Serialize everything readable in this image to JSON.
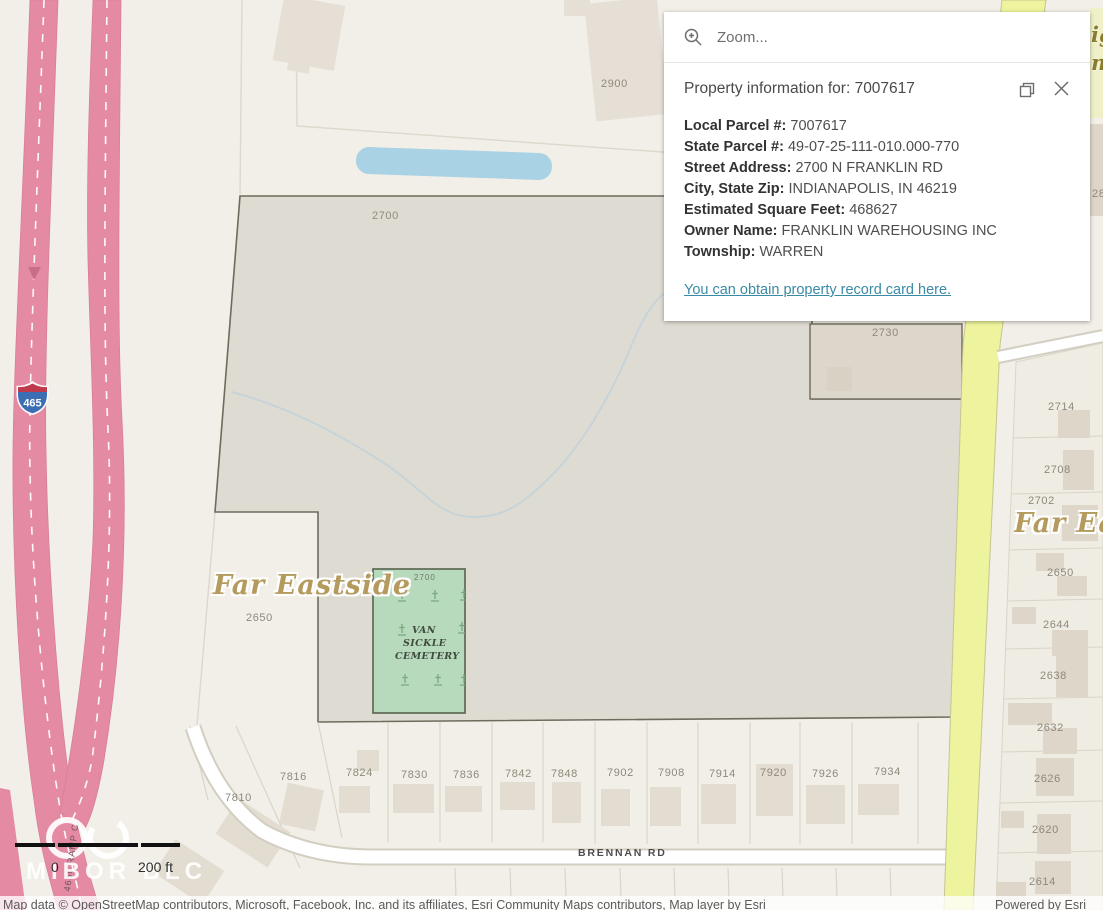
{
  "search": {
    "placeholder": "Zoom..."
  },
  "popup": {
    "title": "Property information for: 7007617",
    "fields": [
      {
        "label": "Local Parcel #:",
        "value": "7007617"
      },
      {
        "label": "State Parcel #:",
        "value": "49-07-25-111-010.000-770"
      },
      {
        "label": "Street Address:",
        "value": "2700 N FRANKLIN RD"
      },
      {
        "label": "City, State Zip:",
        "value": "INDIANAPOLIS, IN 46219"
      },
      {
        "label": "Estimated Square Feet:",
        "value": "468627"
      },
      {
        "label": "Owner Name:",
        "value": "FRANKLIN WAREHOUSING INC"
      },
      {
        "label": "Township:",
        "value": "WARREN"
      }
    ],
    "link_text": "You can obtain property record card here."
  },
  "map": {
    "place_labels": {
      "far_eastside_west": "Far Eastside",
      "far_eastside_east": "Far Eastside",
      "edge_partial_1": "ig",
      "edge_partial_2": "m"
    },
    "cemetery": {
      "parcel_number": "2700",
      "name_lines": [
        "VAN",
        "SICKLE",
        "CEMETERY"
      ]
    },
    "roads": {
      "brennan": "BRENNAN RD",
      "interstate_shield": "465",
      "ramp": "4650 RAMP C"
    },
    "parcel_labels": [
      "2900",
      "2700",
      "2730",
      "2714",
      "2708",
      "2702",
      "2650",
      "2644",
      "2638",
      "2632",
      "2626",
      "2620",
      "2614",
      "2650",
      "7810",
      "7816",
      "7824",
      "7830",
      "7836",
      "7842",
      "7848",
      "7902",
      "7908",
      "7914",
      "7920",
      "7926",
      "7934",
      "28"
    ]
  },
  "scalebar": {
    "start": "0",
    "end": "200 ft"
  },
  "watermark": "MIBOR BLC",
  "attribution": {
    "sources": "Map data © OpenStreetMap contributors, Microsoft, Facebook, Inc. and its affiliates, Esri Community Maps contributors, Map layer by Esri",
    "powered_by": "Powered by Esri"
  },
  "colors": {
    "link_teal": "#3A8AA5",
    "parcel_gray": "#DEDCD2",
    "cemetery_green": "#B7D9BC",
    "highway_pink": "#E48BA3",
    "road_yellow": "#EEF49D",
    "shield_blue": "#3C6EB4",
    "shield_red": "#C03A4D",
    "water_blue": "#A9D2E4"
  }
}
